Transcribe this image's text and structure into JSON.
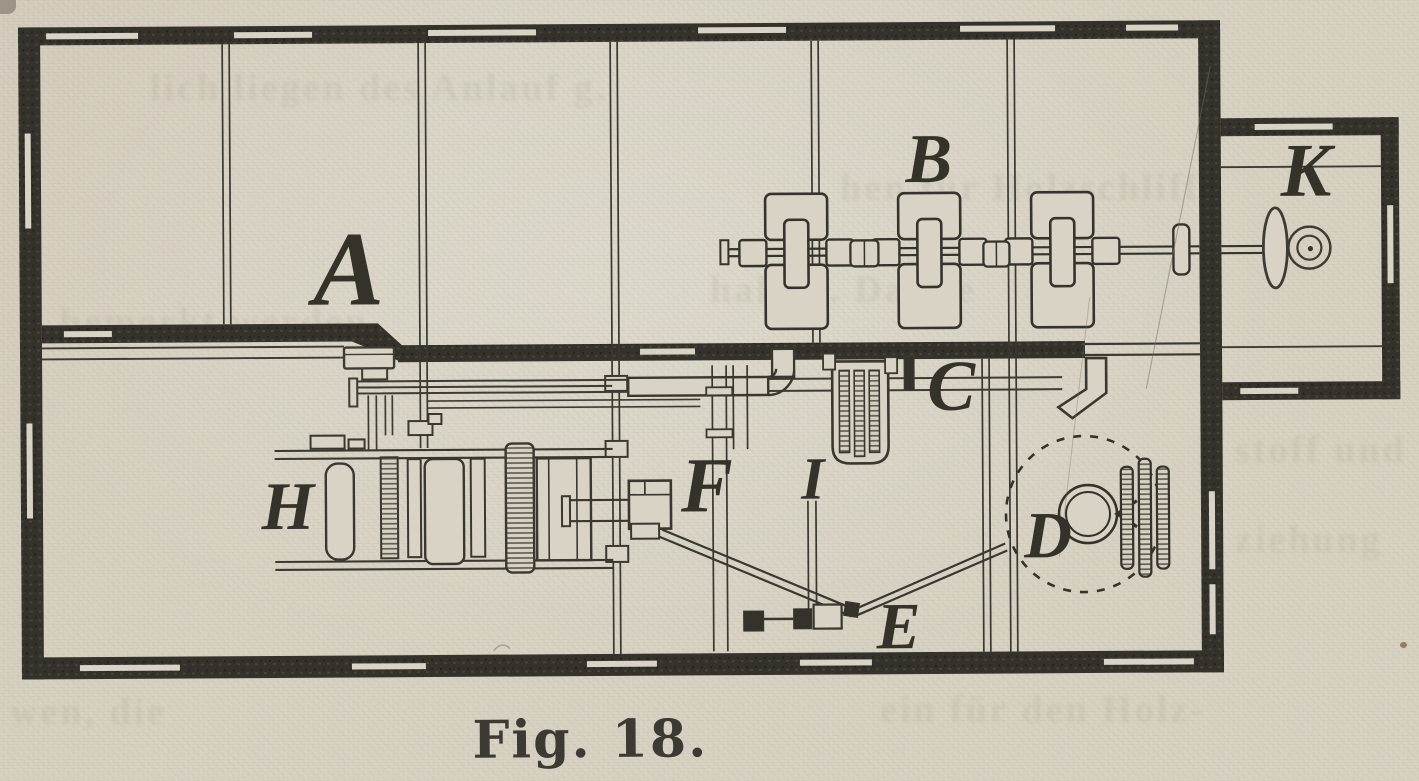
{
  "figure": {
    "caption": "Fig. 18.",
    "labels": {
      "room_a": "A",
      "pulleys_b": "B",
      "duct_c": "C",
      "fan_d": "D",
      "conveyor_e": "E",
      "machine_f": "F",
      "machine_h": "H",
      "device_i": "I",
      "annex_k": "K"
    }
  },
  "ghost_text": {
    "lines": [
      "lich liegen des Anlauf g.",
      "hen für Holzschliff",
      "halten. Da die",
      "bemerkt werden",
      "stoff und",
      "ziehung",
      "wen, die",
      "ein für den Holz-"
    ]
  },
  "colors": {
    "paper": "#d8d3c4",
    "wall_ink": "#34322b",
    "line_ink": "#3e3b32",
    "label_ink": "#35322a"
  }
}
